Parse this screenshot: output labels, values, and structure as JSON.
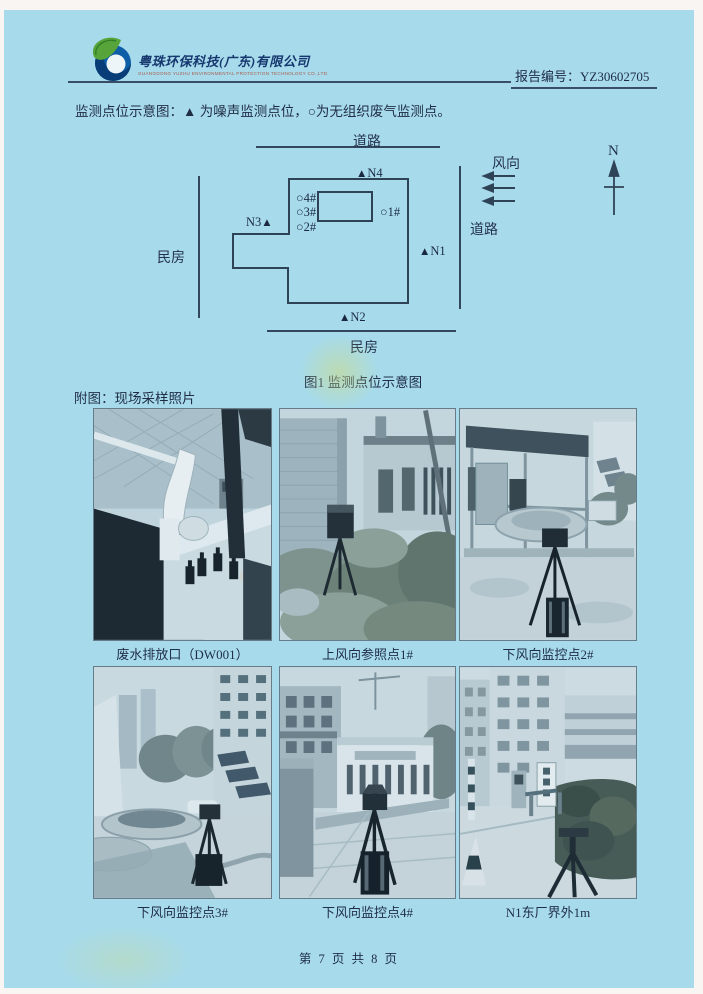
{
  "header": {
    "company_name": "粤珠环保科技(广东)有限公司",
    "company_name_en": "GUANGDONG YUZHU ENVIRONMENTAL PROTECTION TECHNOLOGY CO.,LTD.",
    "report_no": "报告编号：YZ30602705"
  },
  "legend": "监测点位示意图：▲ 为噪声监测点位，○为无组织废气监测点。",
  "diagram": {
    "noise_icon": "▲",
    "gas_icon": "○",
    "labels": {
      "road_top": "道路",
      "road_right": "道路",
      "house_left": "民房",
      "house_bottom": "民房",
      "wind": "风向",
      "north": "N"
    },
    "markers": {
      "n1": "N1",
      "n2": "N2",
      "n3": "N3",
      "n4": "N4",
      "g1": "1#",
      "g2": "2#",
      "g3": "3#",
      "g4": "4#"
    },
    "caption": "图1 监测点位示意图"
  },
  "photos": {
    "section_title": "附图：现场采样照片",
    "items": [
      {
        "caption": "废水排放口（DW001）"
      },
      {
        "caption": "上风向参照点1#"
      },
      {
        "caption": "下风向监控点2#"
      },
      {
        "caption": "下风向监控点3#"
      },
      {
        "caption": "下风向监控点4#"
      },
      {
        "caption": "N1东厂界外1m"
      }
    ]
  },
  "footer": "第 7 页 共 8 页",
  "colors": {
    "paper": "#a7dbec",
    "ink": "#22304a",
    "line": "#32465c"
  }
}
